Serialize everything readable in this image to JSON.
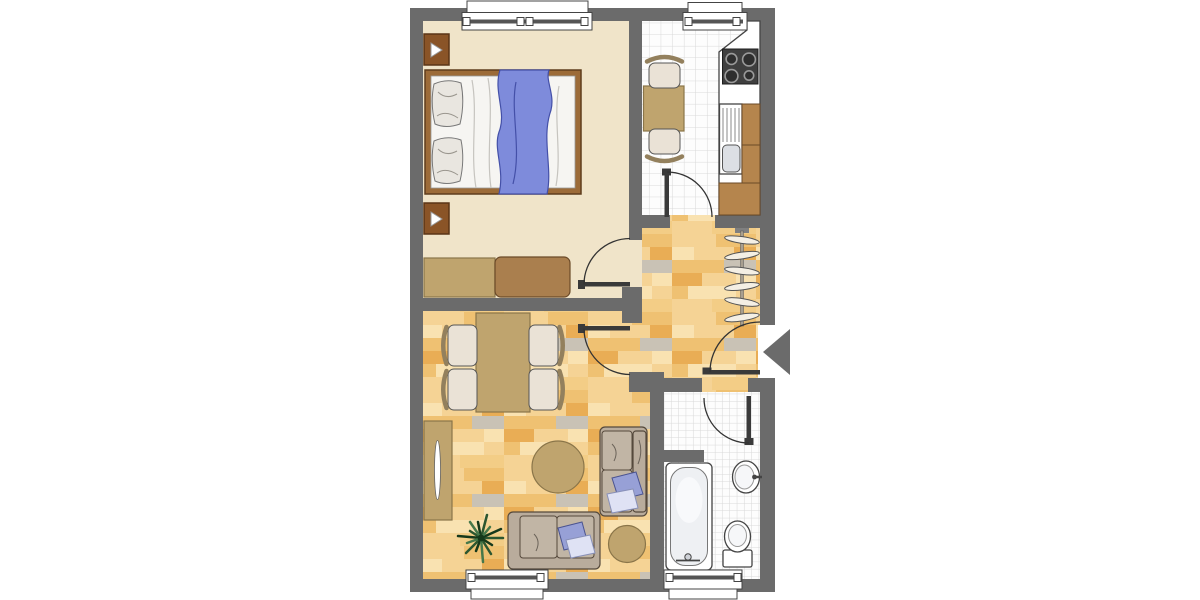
{
  "colors": {
    "wall": "#6b6b6b",
    "floor_bedroom": "#f0e4c9",
    "tile": "#fdfdfd",
    "tile_line": "#d9d9d9",
    "plank1": "#f5d395",
    "plank2": "#efc172",
    "plank3": "#f9e2b1",
    "plank4": "#e9ad55",
    "plank5": "#c9c2b5",
    "plank6": "#f3cd86",
    "door": "#3a3a3a",
    "fixture_white": "#ffffff",
    "fixture_line": "#444444",
    "basin": "#dcdfe4",
    "stove": "#3f3f3f",
    "burner": "#2e2e2e",
    "burner_ring": "#9a9a9a",
    "cab_brown": "#b5854d",
    "cab_brown_line": "#6b4a28",
    "tan": "#bfa46e",
    "tan_line": "#8a7549",
    "chest": "#aa7f4e",
    "bed_frame": "#9c6b38",
    "bed_frame_line": "#5e3c1c",
    "mattress": "#f6f5f2",
    "pillow": "#e9e6e0",
    "pillow_line": "#787878",
    "blanket": "#7e8bdb",
    "blanket_line": "#4450a8",
    "marker": "#8a5427",
    "marker_line": "#5a3517",
    "chair_seat": "#eae2d6",
    "chair_back": "#93805d",
    "sofa": "#b9ac9c",
    "cushion": "#c1b5a5",
    "sofa_line": "#55493c",
    "pillow_blue": "#97a0d6",
    "pillow_blue_line": "#4a5390",
    "pillow_light": "#dfe2f4",
    "pillow_light_line": "#8890b8",
    "plant_dark": "#16391b",
    "plant_mid": "#2c5630",
    "plant_light": "#47784a",
    "hanger": "#f4efe4",
    "rail": "#a89f90",
    "background": "#ffffff"
  },
  "floor": {
    "row_height": 13,
    "rows": [
      [
        [
          0,
          44,
          "plank1"
        ],
        [
          44,
          40,
          "plank2"
        ]
      ],
      [
        [
          0,
          22,
          "plank3"
        ],
        [
          22,
          40,
          "plank1"
        ],
        [
          62,
          22,
          "plank4"
        ]
      ],
      [
        [
          0,
          52,
          "plank2"
        ],
        [
          52,
          32,
          "plank5"
        ]
      ],
      [
        [
          0,
          30,
          "plank4"
        ],
        [
          30,
          34,
          "plank1"
        ],
        [
          64,
          20,
          "plank3"
        ]
      ],
      [
        [
          0,
          16,
          "plank2"
        ],
        [
          16,
          48,
          "plank3"
        ],
        [
          64,
          20,
          "plank1"
        ]
      ],
      [
        [
          0,
          40,
          "plank1"
        ],
        [
          40,
          44,
          "plank6"
        ]
      ]
    ]
  },
  "plan": {
    "type": "apartment-floor-plan",
    "rooms": [
      {
        "id": "bedroom",
        "floor": "plain",
        "furniture": [
          "double-bed",
          "two-pillows",
          "blue-blanket",
          "wall-arrow-marker",
          "wall-arrow-marker",
          "dresser",
          "low-chest"
        ],
        "windows": 1,
        "doors": 1
      },
      {
        "id": "kitchen",
        "floor": "tile",
        "furniture": [
          "small-table",
          "chair",
          "chair",
          "counter",
          "stove-4-burner",
          "sink-with-drainer",
          "cabinet",
          "cabinet",
          "cabinet"
        ],
        "windows": 1,
        "doors": 1
      },
      {
        "id": "hallway",
        "floor": "parquet",
        "furniture": [
          "coat-rack-with-hangers"
        ],
        "windows": 0,
        "doors": 1
      },
      {
        "id": "living-room",
        "floor": "parquet",
        "furniture": [
          "dining-table",
          "chair",
          "chair",
          "chair",
          "chair",
          "sideboard",
          "round-rug",
          "loveseat",
          "sofa",
          "ottoman",
          "potted-plant"
        ],
        "windows": 1,
        "doors": 1
      },
      {
        "id": "bathroom",
        "floor": "tile",
        "furniture": [
          "bathtub",
          "washbasin",
          "toilet"
        ],
        "windows": 1,
        "doors": 1
      }
    ],
    "entrance": {
      "symbol": "arrow",
      "direction": "left"
    }
  }
}
